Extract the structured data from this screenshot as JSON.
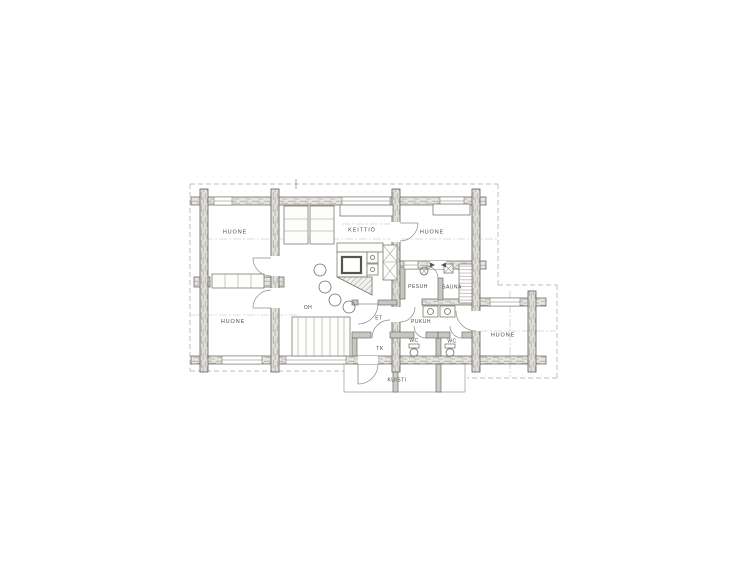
{
  "page": {
    "background": "#ffffff"
  },
  "drawing": {
    "labels": {
      "huone_top_left": "HUONE",
      "keittio": "KEITTIÖ",
      "huone_top_right": "HUONE",
      "pesuh": "PESUH",
      "sauna": "SAUNA",
      "oh": "OH",
      "huone_bottom_left": "HUONE",
      "et": "ET",
      "pukuh": "PUKUH",
      "tk": "TK",
      "wc_left": "WC",
      "wc_right": "WC",
      "huone_wing": "HUONE",
      "kuisti": "KUISTI"
    },
    "colors": {
      "ink": "#4a4a4a",
      "wall_stroke": "#6f6e6a",
      "wall_thin_fill": "#c8c6c1",
      "thin_line": "#9a9a9a",
      "dash_line": "#a8a8a8",
      "paper": "#ffffff"
    }
  }
}
